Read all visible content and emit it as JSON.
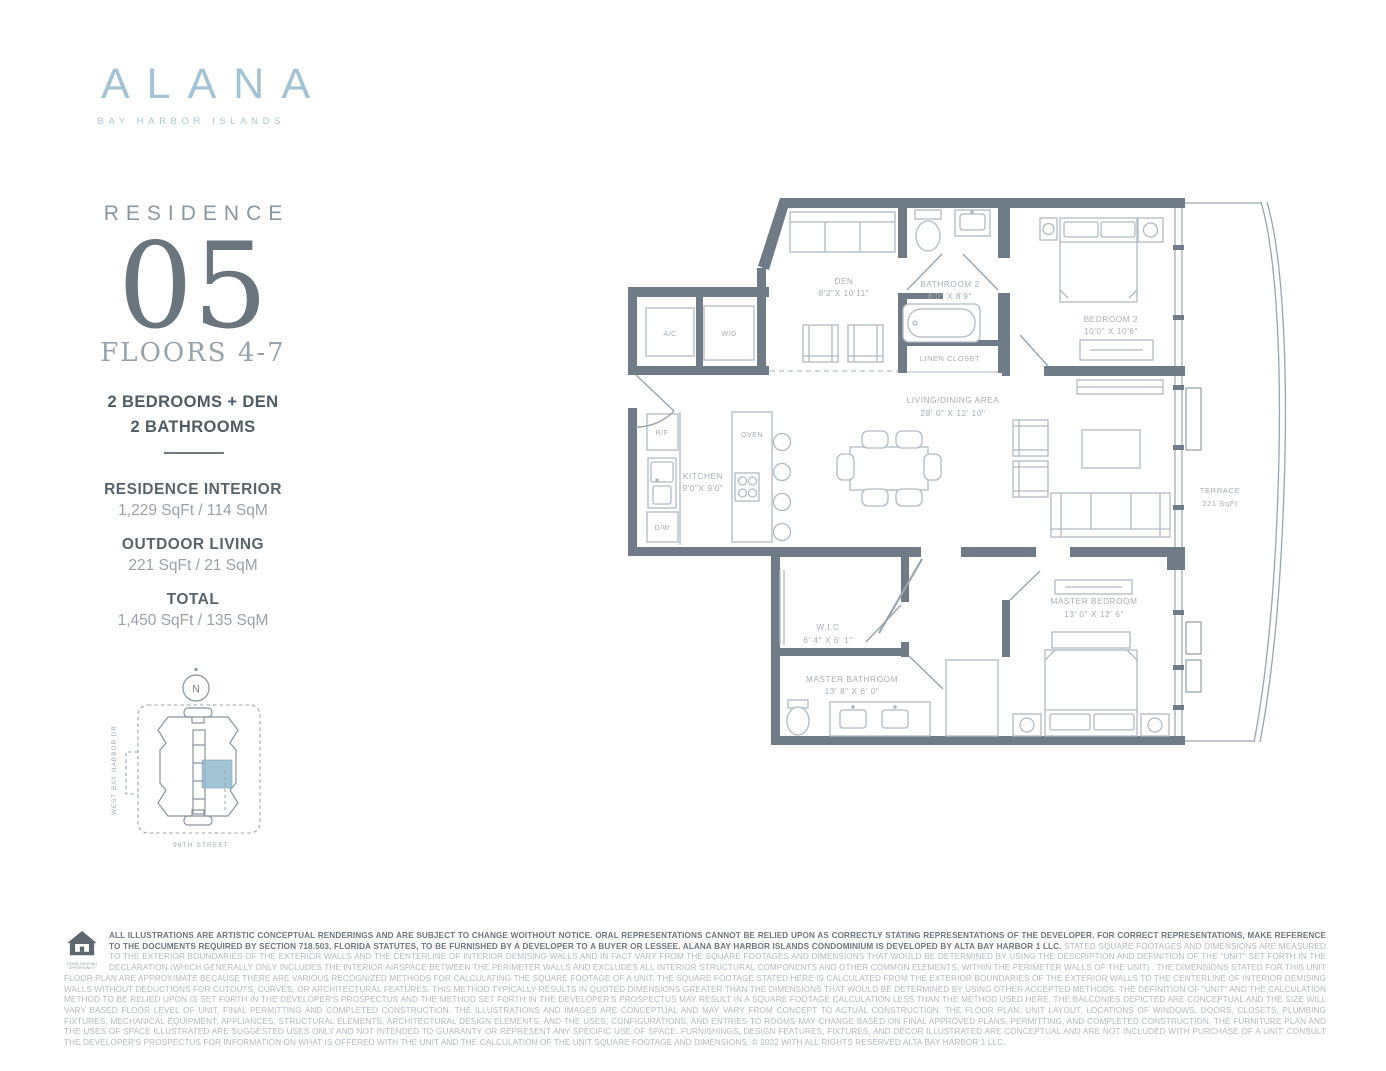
{
  "brand": {
    "name": "ALANA",
    "tagline": "BAY HARBOR ISLANDS"
  },
  "residence": {
    "label": "RESIDENCE",
    "number": "05",
    "floors": "FLOORS 4-7",
    "config_line1": "2 BEDROOMS + DEN",
    "config_line2": "2 BATHROOMS"
  },
  "stats": [
    {
      "label": "RESIDENCE INTERIOR",
      "value": "1,229 SqFt / 114 SqM"
    },
    {
      "label": "OUTDOOR LIVING",
      "value": "221 SqFt / 21 SqM"
    },
    {
      "label": "TOTAL",
      "value": "1,450 SqFt / 135 SqM"
    }
  ],
  "sitemap": {
    "compass": "N",
    "street_west": "WEST BAY HARBOR DR",
    "street_south": "99TH STREET",
    "highlight_color": "#8fb7cb"
  },
  "plan": {
    "wall_color": "#6f7b87",
    "rooms": {
      "den": {
        "name": "DEN",
        "dims": "8'2\"X 10'11\""
      },
      "bathroom2": {
        "name": "BATHROOM 2",
        "dims": "6'0\" X 8'9\""
      },
      "linen": {
        "name": "LINEN CLOSET"
      },
      "bedroom2": {
        "name": "BEDROOM 2",
        "dims": "10'0\" X 10'6\""
      },
      "living": {
        "name": "LIVING/DINING AREA",
        "dims": "28' 0\" X 12' 10\""
      },
      "kitchen": {
        "name": "KITCHEN",
        "dims": "9'0\"X 9'0\""
      },
      "wic": {
        "name": "W.I.C",
        "dims": "6' 4\" X 6' 1\""
      },
      "master_bathroom": {
        "name": "MASTER BATHROOM",
        "dims": "13' 8\" X 6' 0\""
      },
      "master_bedroom": {
        "name": "MASTER BEDROOM",
        "dims": "13' 0\" X 12' 6\""
      },
      "terrace": {
        "name": "TERRACE",
        "dims": "221 SqFt"
      }
    },
    "fixtures": {
      "ac": "A/C",
      "wd": "W/D",
      "rf": "R/F",
      "dw": "D/W",
      "oven": "OVEN"
    }
  },
  "footer": {
    "equal_housing_line1": "EQUAL HOUSING",
    "equal_housing_line2": "OPPORTUNITY",
    "disclaimer_bold": "ALL ILLUSTRATIONS ARE ARTISTIC CONCEPTUAL RENDERINGS AND ARE SUBJECT TO CHANGE WOITHOUT NOTICE. ORAL REPRESENTATIONS CANNOT BE RELIED UPON AS CORRECTLY STATING REPRESENTATIONS OF THE DEVELOPER. FOR CORRECT REPRESENTATIONS, MAKE REFERENCE TO THE DOCUMENTS REQUIRED BY SECTION 718.503, FLORIDA STATUTES, TO BE FURNISHED BY A DEVELOPER TO A BUYER OR LESSEE. ALANA BAY HARBOR ISLANDS CONDOMINIUM IS DEVELOPED BY ALTA BAY HARBOR 1 LLC.",
    "disclaimer_regular": "STATED SQUARE FOOTAGES AND DIMENSIONS ARE MEASURED TO THE EXTERIOR BOUNDARIES OF THE EXTERIOR WALLS AND THE CENTERLINE OF INTERIOR DEMISING WALLS AND IN FACT VARY FROM THE SQUARE FOOTAGES AND DIMENSIONS THAT WOULD BE DETERMINED BY USING THE DESCRIPTION AND DEFINITION OF THE \"UNIT\" SET FORTH IN THE DECLARATION (WHICH GENERALLY ONLY INCLUDES THE INTERIOR AIRSPACE BETWEEN THE PERIMETER WALLS AND EXCLUDES ALL INTERIOR STRUCTURAL COMPONENTS AND OTHER COMMON ELEMENTS, WITHIN THE PERIMETER WALLS OF THE UNIT) . THE DIMENSIONS STATED FOR THIS UNIT FLOOR PLAN ARE APPROXIMATE BECAUSE THERE ARE VARIOUS RECOGNIZED METHODS FOR CALCULATING THE SQUARE FOOTAGE OF A UNIT. THE SQUARE FOOTAGE STATED HERE IS CALCULATED FROM THE EXTERIOR BOUNDARIES OF THE EXTERIOR WALLS TO THE CENTERLINE OF INTERIOR DEMISING WALLS WITHOUT DEDUCTIONS FOR CUTOUTS, CURVES, OR ARCHITECTURAL FEATURES. THIS METHOD TYPICALLY RESULTS IN QUOTED DIMENSIONS GREATER THAN THE DIMENSIONS THAT WOULD BE DETERMINED BY USING OTHER ACCEPTED METHODS. THE DEFINITION OF \"UNIT\" AND THE CALCULATION METHOD TO BE RELIED UPON IS SET FORTH IN THE DEVELOPER'S PROSPECTUS AND THE METHOD SET FORTH IN THE DEVELOPER'S PROSPECTUS MAY RESULT IN A SQUARE FOOTAGE CALCULATION LESS THAN THE METHOD USED HERE. THE BALCONIES DEPICTED ARE CONCEPTUAL AND THE SIZE WILL VARY BASED FLOOR LEVEL OF UNIT, FINAL PERMITTING AND COMPLETED CONSTRUCTION. THE ILLUSTRATIONS AND IMAGES ARE CONCEPTUAL AND MAY VARY FROM CONCEPT TO ACTUAL CONSTRUCTION. THE FLOOR PLAN, UNIT LAYOUT, LOCATIONS OF WINDOWS, DOORS, CLOSETS, PLUMBING FIXTURES, MECHANICAL EQUIPMENT, APPLIANCES, STRUCTURAL ELEMENTS, ARCHITECTURAL DESIGN ELEMENTS, AND THE USES, CONFIGURATIONS, AND ENTRIES TO ROOMS MAY CHANGE BASED ON FINAL APPROVED PLANS, PERMITTING, AND COMPLETED CONSTRUCTION. THE FURNITURE PLAN AND THE USES OF SPACE ILLUSTRATED ARE SUGGESTED USES ONLY AND NOT INTENDED TO GUARANTY OR REPRESENT ANY SPECIFIC USE OF SPACE. FURNISHINGS, DESIGN FEATURES, FIXTURES, AND DÉCOR ILLUSTRATED ARE CONCEPTUAL AND ARE NOT INCLUDED WITH PURCHASE OF A UNIT. CONSULT THE DEVELOPER'S PROSPECTUS FOR INFORMATION ON WHAT IS OFFERED WITH THE UNIT AND THE CALCULATION OF THE UNIT SQUARE FOOTAGE AND DIMENSIONS. © 2022 WITH ALL RIGHTS RESERVED ALTA BAY HARBOR 1 LLC."
  }
}
